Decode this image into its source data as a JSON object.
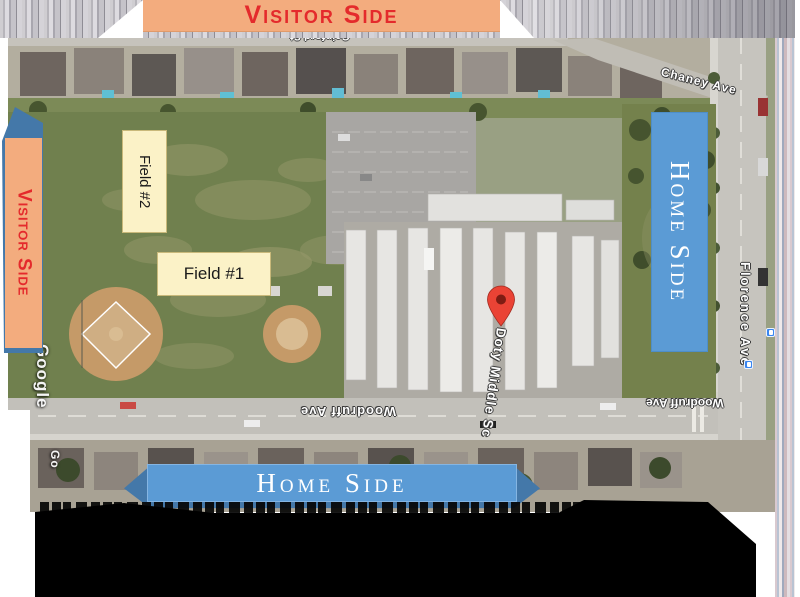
{
  "banners": {
    "top": "Visitor Side",
    "left": "Visitor Side",
    "right": "Home Side",
    "bottom": "Home Side"
  },
  "field_labels": {
    "field1": "Field #1",
    "field2": "Field #2"
  },
  "map": {
    "streets": {
      "chaney": "Chaney Ave",
      "florence": "Florence Ave",
      "woodruff_center": "Woodruff Ave",
      "woodruff_right": "Woodruff Ave",
      "top_partial": "Gainford St"
    },
    "place_label": "Doty Middle Sc",
    "watermark": "Google",
    "watermark_partial": "Go"
  },
  "colors": {
    "visitor_banner_bg": "#f3ac7e",
    "visitor_text": "#e42a2c",
    "home_banner_bg": "#5b9bd5",
    "home_banner_dark": "#4478a9",
    "field_label_bg": "#fbf2c7",
    "pin_red": "#ea4335"
  }
}
